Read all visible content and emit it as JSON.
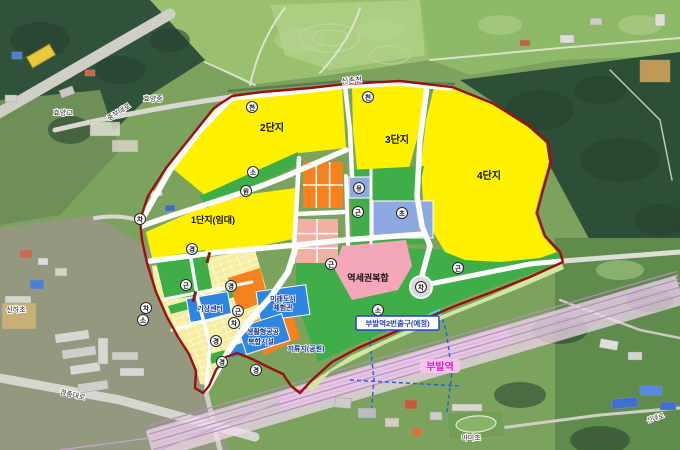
{
  "map": {
    "complexes": {
      "c1": "1단지(임대)",
      "c2": "2단지",
      "c3": "3단지",
      "c4": "4단지",
      "station_mixed": "역세권복합"
    },
    "facilities": {
      "weather_center": "기상센터",
      "future_city_l1": "미래도시",
      "future_city_l2": "체험관",
      "living_public_l1": "생활형공공",
      "living_public_l2": "복합시설",
      "retention_pond": "저류지(공원)"
    },
    "station": {
      "exit_label": "부발역2번출구(예정)",
      "name": "부발역"
    },
    "base_labels": {
      "stream": "신촌천",
      "hyoyang_school_1": "효양고",
      "hyoyang_school_2": "효양중",
      "jungbu_road": "중부대로",
      "gyeongchung_road": "경충대로",
      "sinha_school": "신하초",
      "ami_school": "아미초",
      "sindae_road": "신대로"
    },
    "markers": [
      {
        "char": "차"
      },
      {
        "char": "천"
      },
      {
        "char": "소"
      },
      {
        "char": "원"
      },
      {
        "char": "천"
      },
      {
        "char": "유"
      },
      {
        "char": "근"
      },
      {
        "char": "초"
      },
      {
        "char": "근"
      },
      {
        "char": "경"
      },
      {
        "char": "근"
      },
      {
        "char": "경"
      },
      {
        "char": "차"
      },
      {
        "char": "소"
      },
      {
        "char": "근"
      },
      {
        "char": "차"
      },
      {
        "char": "경"
      },
      {
        "char": "경"
      },
      {
        "char": "경"
      },
      {
        "char": "차"
      },
      {
        "char": "근"
      },
      {
        "char": "소"
      }
    ],
    "legend_colors": {
      "district_boundary": "#9b1010",
      "residential_yellow": "#fff100",
      "park_green": "#3fae49",
      "commercial_orange": "#f5821f",
      "mixed_use_pink": "#f4a7b9",
      "block_salmon": "#f2afa4",
      "public_facility_blue": "#2e86e0",
      "school_blue": "#8ea9e2",
      "retention_pond_green": "#cfe8a0",
      "railway_pink": "#e3bfe3",
      "exit_structure_cyan": "#3fe0d4",
      "station_label_magenta": "#e619c3",
      "planned_road_blue": "#2b5fd9"
    }
  }
}
